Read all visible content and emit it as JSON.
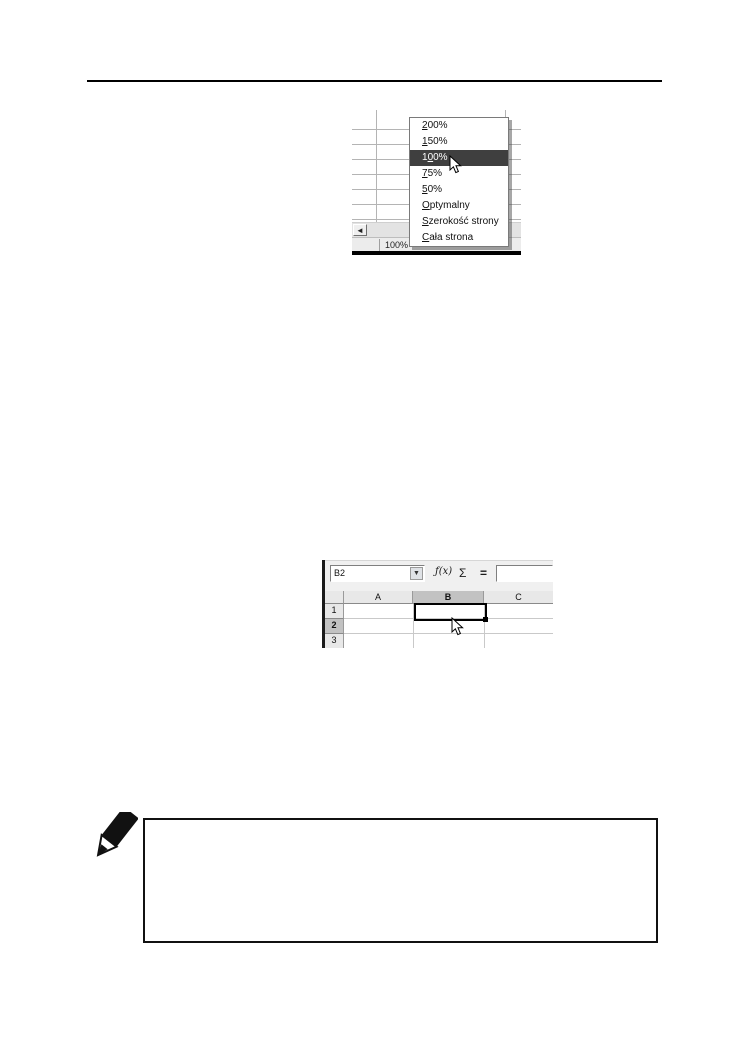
{
  "page": {
    "background": "#ffffff",
    "note_text": ""
  },
  "colors": {
    "menu_highlight": "#3f3f3f",
    "menu_highlight_text": "#ffffff",
    "header_selected": "#c2c2c2",
    "grid_line": "#b4b4b4"
  },
  "zoom_screenshot": {
    "status_zoom": "100%",
    "scroll_left_glyph": "◄",
    "menu": {
      "highlighted_index": 2,
      "items": [
        {
          "pre": "",
          "accel": "2",
          "post": "00%"
        },
        {
          "pre": "",
          "accel": "1",
          "post": "50%"
        },
        {
          "pre": "1",
          "accel": "0",
          "post": "0%"
        },
        {
          "pre": "",
          "accel": "7",
          "post": "5%"
        },
        {
          "pre": "",
          "accel": "5",
          "post": "0%"
        },
        {
          "pre": "",
          "accel": "O",
          "post": "ptymalny"
        },
        {
          "pre": "",
          "accel": "S",
          "post": "zerokość strony"
        },
        {
          "pre": "",
          "accel": "C",
          "post": "ała strona"
        }
      ]
    }
  },
  "calc_screenshot": {
    "name_box": {
      "value": "B2",
      "dropdown_glyph": "▼"
    },
    "formula_icons": {
      "function_wizard": "ƒ(x)",
      "sum": "Σ",
      "equals": "="
    },
    "formula_input": {
      "value": ""
    },
    "column_headers": [
      "A",
      "B",
      "C"
    ],
    "row_headers": [
      "1",
      "2",
      "3"
    ],
    "selected_cell": "B2",
    "selected_column": "B",
    "selected_row": "2"
  }
}
